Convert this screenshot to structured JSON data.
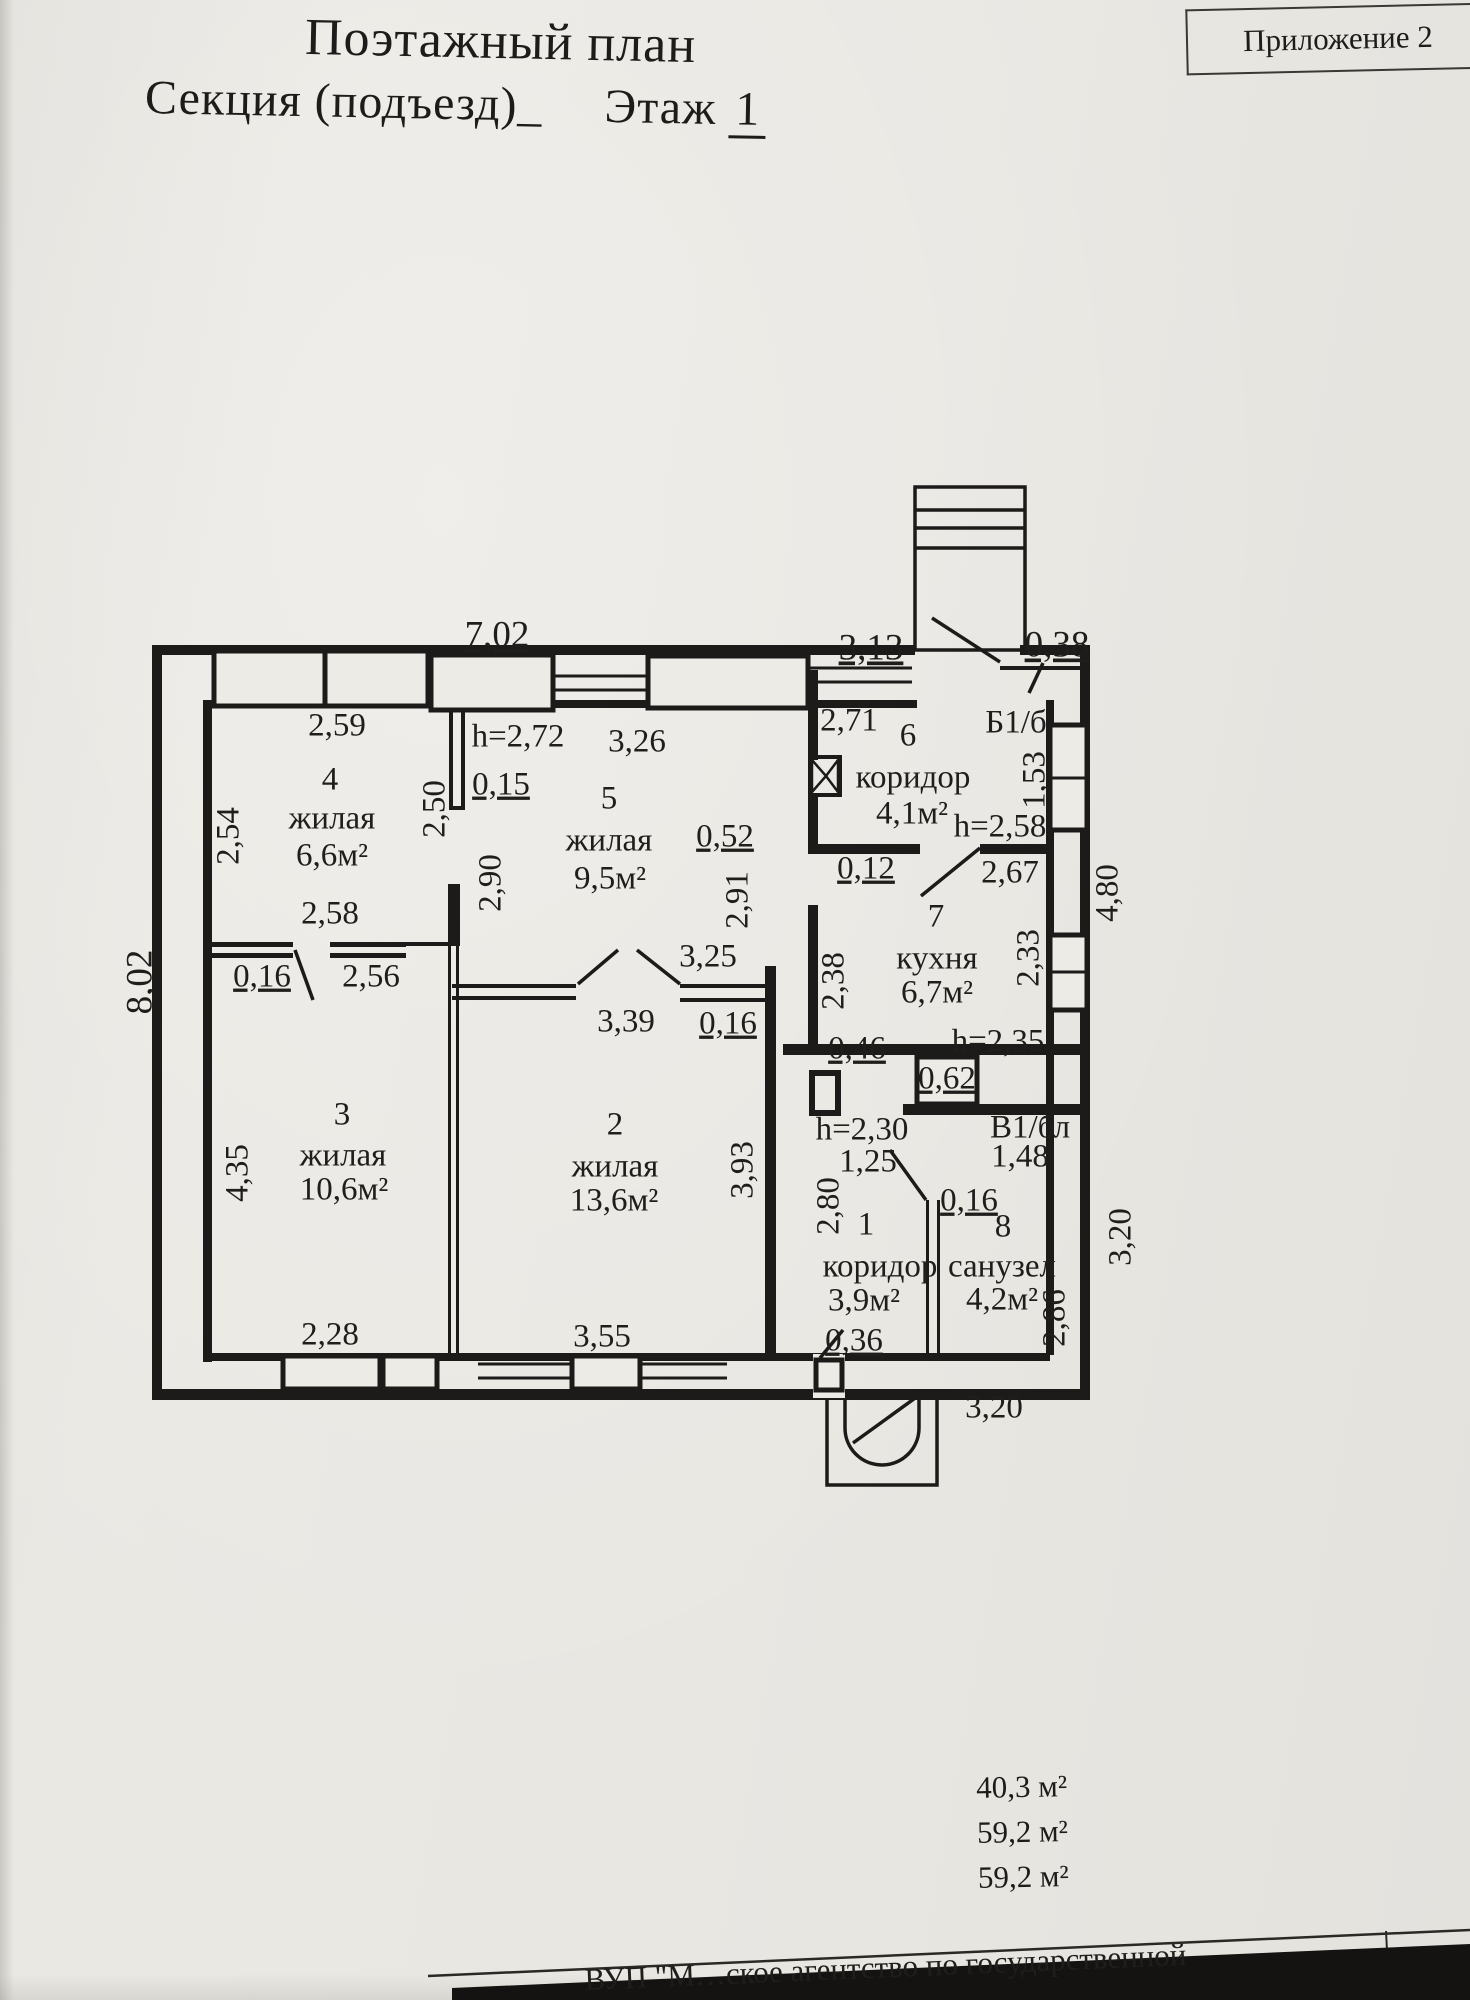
{
  "header": {
    "appendix": "Приложение 2",
    "title": "Поэтажный план",
    "section_label": "Секция (подъезд)_",
    "floor_label": "Этаж",
    "floor_number": "1"
  },
  "colors": {
    "paper": "#e9e7e2",
    "ink": "#1d1c1a"
  },
  "plan": {
    "labels": [
      {
        "t": "7,02",
        "x": 497,
        "y": 638,
        "s": 37,
        "u": 1
      },
      {
        "t": "3,13",
        "x": 871,
        "y": 651,
        "s": 37,
        "u": 1
      },
      {
        "t": "0,38",
        "x": 1057,
        "y": 648,
        "s": 37,
        "u": 1
      },
      {
        "t": "2,59",
        "x": 337,
        "y": 728,
        "s": 33
      },
      {
        "t": "4",
        "x": 330,
        "y": 782,
        "s": 33
      },
      {
        "t": "жилая",
        "x": 332,
        "y": 821,
        "s": 33
      },
      {
        "t": "6,6м²",
        "x": 332,
        "y": 858,
        "s": 33
      },
      {
        "t": "2,54",
        "x": 231,
        "y": 836,
        "s": 33,
        "r": -90
      },
      {
        "t": "2,50",
        "x": 437,
        "y": 809,
        "s": 33,
        "r": -90
      },
      {
        "t": "h=2,72",
        "x": 518,
        "y": 739,
        "s": 33
      },
      {
        "t": "0,15",
        "x": 501,
        "y": 787,
        "s": 33,
        "u": 1
      },
      {
        "t": "3,26",
        "x": 637,
        "y": 744,
        "s": 33
      },
      {
        "t": "5",
        "x": 609,
        "y": 801,
        "s": 33
      },
      {
        "t": "жилая",
        "x": 609,
        "y": 843,
        "s": 33
      },
      {
        "t": "9,5м²",
        "x": 610,
        "y": 881,
        "s": 33
      },
      {
        "t": "2,90",
        "x": 493,
        "y": 883,
        "s": 33,
        "r": -90
      },
      {
        "t": "0,52",
        "x": 725,
        "y": 839,
        "s": 33,
        "u": 1
      },
      {
        "t": "2,91",
        "x": 740,
        "y": 900,
        "s": 33,
        "r": -90
      },
      {
        "t": "2,71",
        "x": 849,
        "y": 723,
        "s": 33
      },
      {
        "t": "6",
        "x": 908,
        "y": 738,
        "s": 33
      },
      {
        "t": "коридор",
        "x": 913,
        "y": 780,
        "s": 33
      },
      {
        "t": "4,1м²",
        "x": 912,
        "y": 816,
        "s": 33
      },
      {
        "t": "Б1/б",
        "x": 1016,
        "y": 725,
        "s": 33
      },
      {
        "t": "1,53",
        "x": 1037,
        "y": 780,
        "s": 33,
        "r": -90
      },
      {
        "t": "h=2,58",
        "x": 1000,
        "y": 829,
        "s": 33
      },
      {
        "t": "2,67",
        "x": 1010,
        "y": 875,
        "s": 33
      },
      {
        "t": "0,12",
        "x": 866,
        "y": 871,
        "s": 33,
        "u": 1
      },
      {
        "t": "4,80",
        "x": 1110,
        "y": 893,
        "s": 33,
        "r": -90
      },
      {
        "t": "7",
        "x": 936,
        "y": 919,
        "s": 33
      },
      {
        "t": "кухня",
        "x": 937,
        "y": 961,
        "s": 33
      },
      {
        "t": "6,7м²",
        "x": 937,
        "y": 995,
        "s": 33
      },
      {
        "t": "2,33",
        "x": 1031,
        "y": 958,
        "s": 33,
        "r": -90
      },
      {
        "t": "2,38",
        "x": 836,
        "y": 981,
        "s": 33,
        "r": -90
      },
      {
        "t": "3,25",
        "x": 708,
        "y": 959,
        "s": 33
      },
      {
        "t": "0,16",
        "x": 728,
        "y": 1026,
        "s": 33,
        "u": 1
      },
      {
        "t": "3,39",
        "x": 626,
        "y": 1024,
        "s": 33
      },
      {
        "t": "2,58",
        "x": 330,
        "y": 916,
        "s": 33
      },
      {
        "t": "0,16",
        "x": 262,
        "y": 979,
        "s": 33,
        "u": 1
      },
      {
        "t": "2,56",
        "x": 371,
        "y": 979,
        "s": 33
      },
      {
        "t": "8,02",
        "x": 143,
        "y": 982,
        "s": 37,
        "r": -90
      },
      {
        "t": "h=2,35",
        "x": 998,
        "y": 1044,
        "s": 33
      },
      {
        "t": "0,46",
        "x": 857,
        "y": 1051,
        "s": 33,
        "u": 1
      },
      {
        "t": "0,62",
        "x": 947,
        "y": 1081,
        "s": 33,
        "u": 1
      },
      {
        "t": "3",
        "x": 342,
        "y": 1117,
        "s": 33
      },
      {
        "t": "жилая",
        "x": 343,
        "y": 1158,
        "s": 33
      },
      {
        "t": "10,6м²",
        "x": 344,
        "y": 1192,
        "s": 33
      },
      {
        "t": "4,35",
        "x": 240,
        "y": 1173,
        "s": 33,
        "r": -90
      },
      {
        "t": "2",
        "x": 615,
        "y": 1127,
        "s": 33
      },
      {
        "t": "жилая",
        "x": 615,
        "y": 1169,
        "s": 33
      },
      {
        "t": "13,6м²",
        "x": 614,
        "y": 1203,
        "s": 33
      },
      {
        "t": "3,93",
        "x": 745,
        "y": 1170,
        "s": 33,
        "r": -90
      },
      {
        "t": "h=2,30",
        "x": 862,
        "y": 1132,
        "s": 33
      },
      {
        "t": "1,25",
        "x": 868,
        "y": 1164,
        "s": 33
      },
      {
        "t": "2,80",
        "x": 831,
        "y": 1206,
        "s": 33,
        "r": -90
      },
      {
        "t": "1",
        "x": 866,
        "y": 1227,
        "s": 33
      },
      {
        "t": "коридор",
        "x": 880,
        "y": 1269,
        "s": 33
      },
      {
        "t": "3,9м²",
        "x": 864,
        "y": 1303,
        "s": 33
      },
      {
        "t": "0,36",
        "x": 854,
        "y": 1343,
        "s": 33,
        "u": 1
      },
      {
        "t": "В1/бл",
        "x": 1030,
        "y": 1130,
        "s": 33
      },
      {
        "t": "1,48",
        "x": 1020,
        "y": 1159,
        "s": 33
      },
      {
        "t": "0,16",
        "x": 969,
        "y": 1203,
        "s": 33,
        "u": 1
      },
      {
        "t": "8",
        "x": 1003,
        "y": 1229,
        "s": 33
      },
      {
        "t": "санузел",
        "x": 1002,
        "y": 1269,
        "s": 33
      },
      {
        "t": "4,2м²",
        "x": 1002,
        "y": 1302,
        "s": 33
      },
      {
        "t": "2,86",
        "x": 1057,
        "y": 1318,
        "s": 33,
        "r": -90
      },
      {
        "t": "3,20",
        "x": 1123,
        "y": 1237,
        "s": 33,
        "r": -90
      },
      {
        "t": "2,28",
        "x": 330,
        "y": 1337,
        "s": 33
      },
      {
        "t": "3,55",
        "x": 602,
        "y": 1339,
        "s": 33
      },
      {
        "t": "3,20",
        "x": 994,
        "y": 1410,
        "s": 33
      }
    ]
  },
  "summary": {
    "areas": [
      "40,3 м²",
      "59,2 м²",
      "59,2 м²"
    ]
  },
  "footer": {
    "text": "ВУП \"М…ское агентство по государственной"
  }
}
